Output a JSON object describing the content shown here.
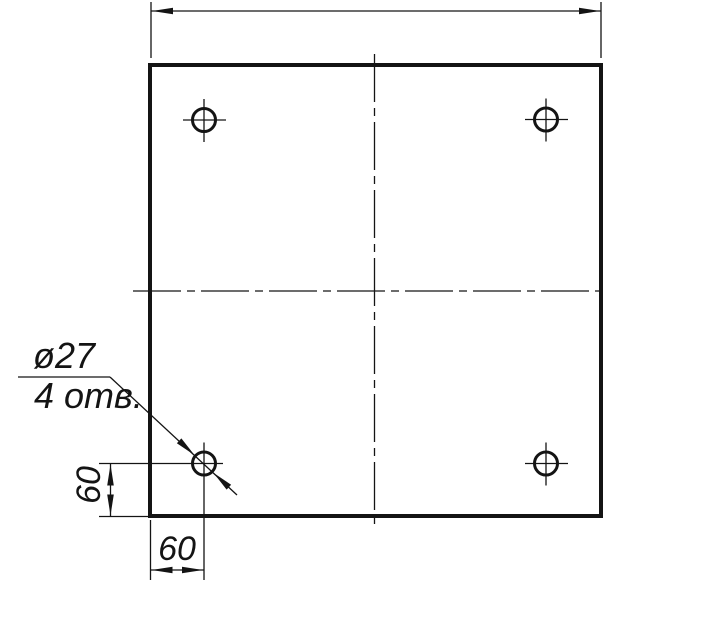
{
  "drawing": {
    "background_color": "#ffffff",
    "line_color": "#141414",
    "callout": {
      "diameter_label": "ø27",
      "count_label": "4 отв."
    },
    "dimensions": {
      "hole_offset_vertical_label": "60",
      "hole_offset_horizontal_label": "60"
    },
    "part": {
      "type": "square plate, top view",
      "holes": {
        "count": 4,
        "diameter": 27,
        "offset_from_left_edge": 60,
        "offset_from_bottom_edge": 60,
        "positions": [
          "top-left",
          "top-right",
          "bottom-left",
          "bottom-right"
        ]
      }
    }
  }
}
